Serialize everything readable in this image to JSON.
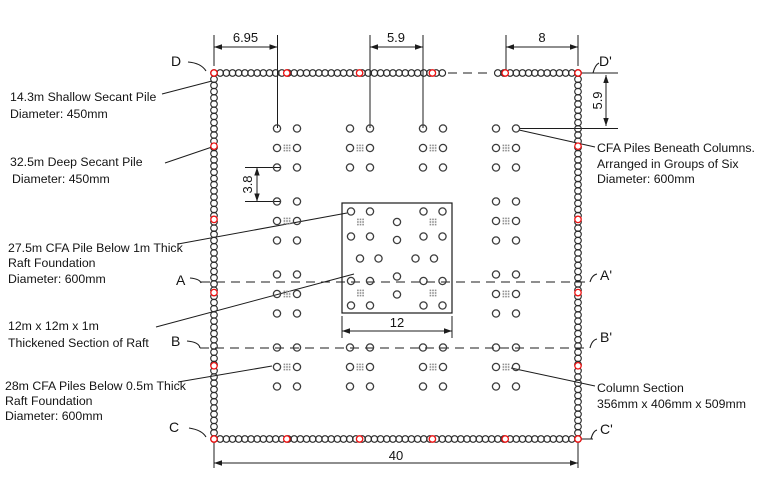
{
  "diagram": {
    "dimensions": {
      "top_left": "6.95",
      "top_middle": "5.9",
      "top_right": "8",
      "right_side": "5.9",
      "pile_row_spacing": "3.8",
      "thickened_width": "12",
      "overall_width": "40"
    },
    "section_markers": {
      "d": "D",
      "d_prime": "D'",
      "a": "A",
      "a_prime": "A'",
      "b": "B",
      "b_prime": "B'",
      "c": "C",
      "c_prime": "C'"
    },
    "labels": {
      "shallow_secant": {
        "line1": "14.3m Shallow Secant Pile",
        "line2": "Diameter: 450mm"
      },
      "deep_secant": {
        "line1": "32.5m Deep Secant Pile",
        "line2": "Diameter: 450mm"
      },
      "cfa_thick_raft": {
        "line1": "27.5m CFA Pile Below 1m Thick",
        "line2": "Raft Foundation",
        "line3": "Diameter: 600mm"
      },
      "thickened_raft": {
        "line1": "12m x 12m x 1m",
        "line2": "Thickened Section of Raft"
      },
      "cfa_thin_raft": {
        "line1": "28m CFA Piles Below 0.5m Thick",
        "line2": "Raft Foundation",
        "line3": "Diameter: 600mm"
      },
      "cfa_columns": {
        "line1": "CFA Piles Beneath Columns.",
        "line2": "Arranged in Groups of Six",
        "line3": "Diameter: 600mm"
      },
      "column_section": {
        "line1": "Column Section",
        "line2": "356mm x 406mm x 509mm"
      }
    },
    "colors": {
      "deep_pile_marker": "#ee1111",
      "pile_outline": "#3d3d3d",
      "wall_outline": "#2b2b2b",
      "line": "#1c1c1c",
      "hatch": "#8f8f8f",
      "background": "#ffffff"
    }
  }
}
